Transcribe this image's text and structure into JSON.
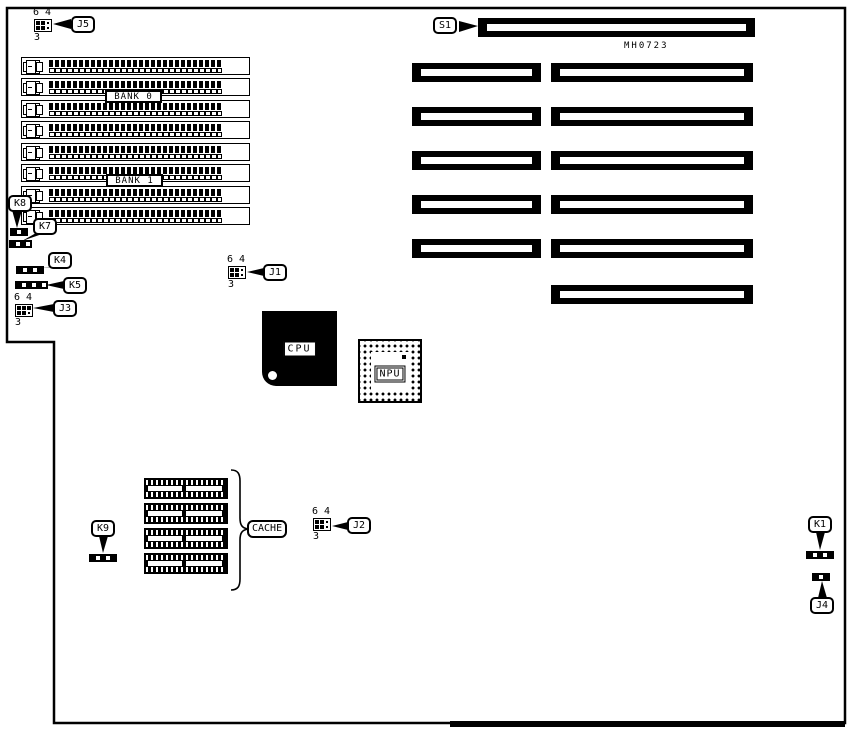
{
  "board": {
    "part_number": "MH0723",
    "banks": {
      "bank0": "BANK 0",
      "bank1": "BANK 1"
    },
    "chips": {
      "cpu": "CPU",
      "npu": "NPU",
      "cache": "CACHE"
    },
    "callouts": {
      "s1": "S1",
      "j1": "J1",
      "j2": "J2",
      "j3": "J3",
      "j4": "J4",
      "j5": "J5",
      "k1": "K1",
      "k4": "K4",
      "k5": "K5",
      "k7": "K7",
      "k8": "K8",
      "k9": "K9"
    },
    "jumper_pin_labels": {
      "p6": "6",
      "p4": "4",
      "p3": "3"
    },
    "colors": {
      "ink": "#000000",
      "paper": "#ffffff"
    }
  }
}
